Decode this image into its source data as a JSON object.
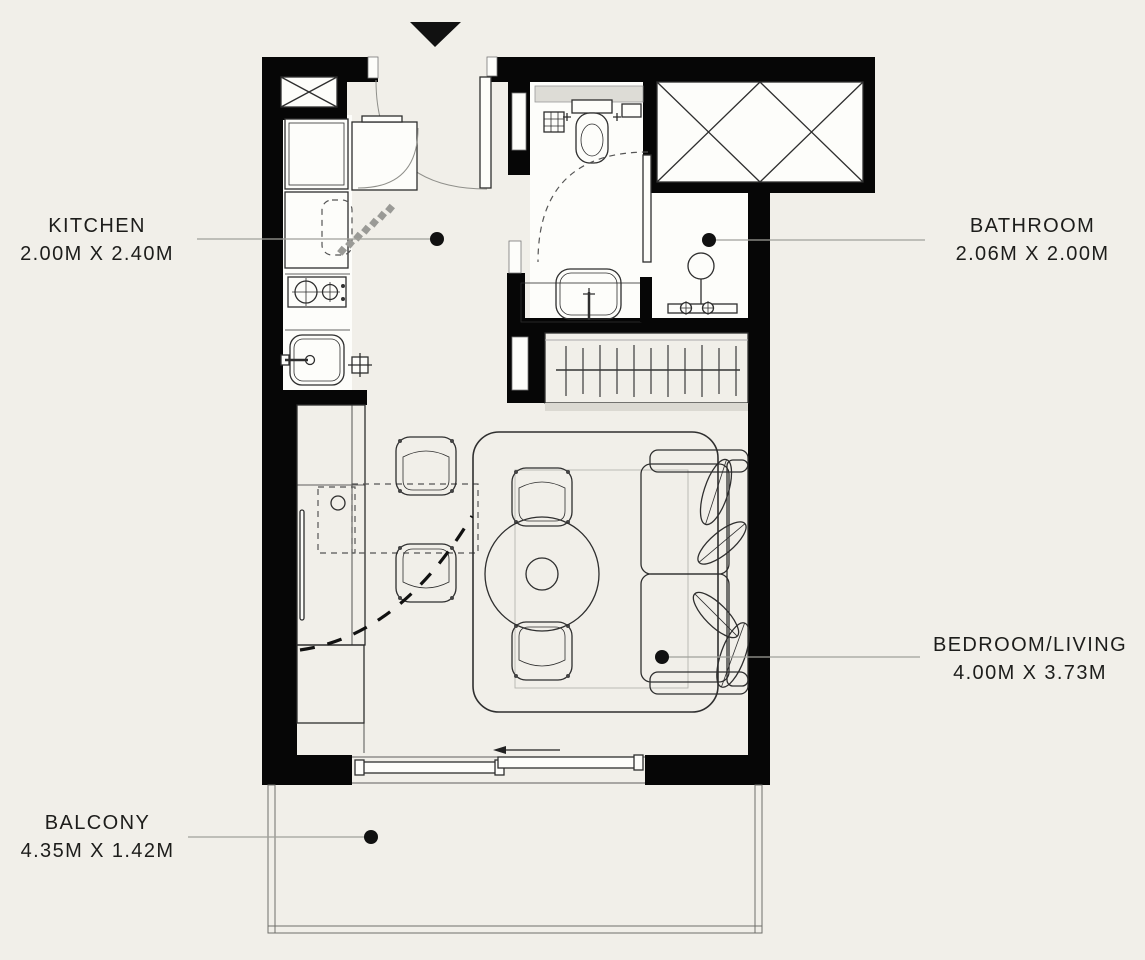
{
  "colors": {
    "background": "#f1efe9",
    "wall": "#060606",
    "white": "#fdfdfa",
    "line": "#2e2e2e",
    "line_light": "#8f8f8a",
    "leader": "#a0a09a",
    "text": "#1d1d1b",
    "shade": "#dbd9d2"
  },
  "rooms": {
    "kitchen": {
      "label": "KITCHEN",
      "dimensions": "2.00M X 2.40M"
    },
    "bathroom": {
      "label": "BATHROOM",
      "dimensions": "2.06M X 2.00M"
    },
    "bedroom_living": {
      "label": "BEDROOM/LIVING",
      "dimensions": "4.00M X 3.73M"
    },
    "balcony": {
      "label": "BALCONY",
      "dimensions": "4.35M X 1.42M"
    }
  }
}
